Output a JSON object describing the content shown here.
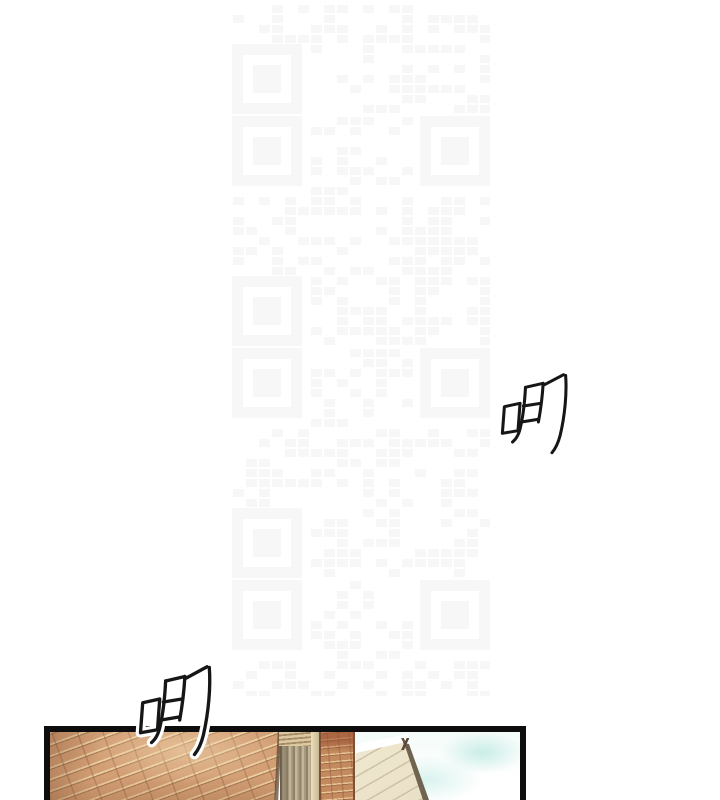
{
  "page": {
    "background": "#ffffff"
  },
  "sfx": {
    "first": {
      "text": "唧"
    },
    "second": {
      "text": "唧"
    }
  },
  "panel": {
    "border_color": "#0d0d0d",
    "scene_colors": {
      "wall_brick": "#d29e74",
      "brick_highlight": "#ecd0a8",
      "brick_mortar_dark": "#8d5f3f",
      "pillar_brick": "#c28a5e",
      "shutter_slats": "#b3a58a",
      "awning_cream": "#f2ebd7",
      "awning_edge": "#6e6450",
      "sky_patch": "#c9ede7",
      "sky_base": "#f3fbf9"
    }
  },
  "watermark": {
    "name": "qr-watermark",
    "color": "#f7f7f7",
    "tile_count": 4
  }
}
